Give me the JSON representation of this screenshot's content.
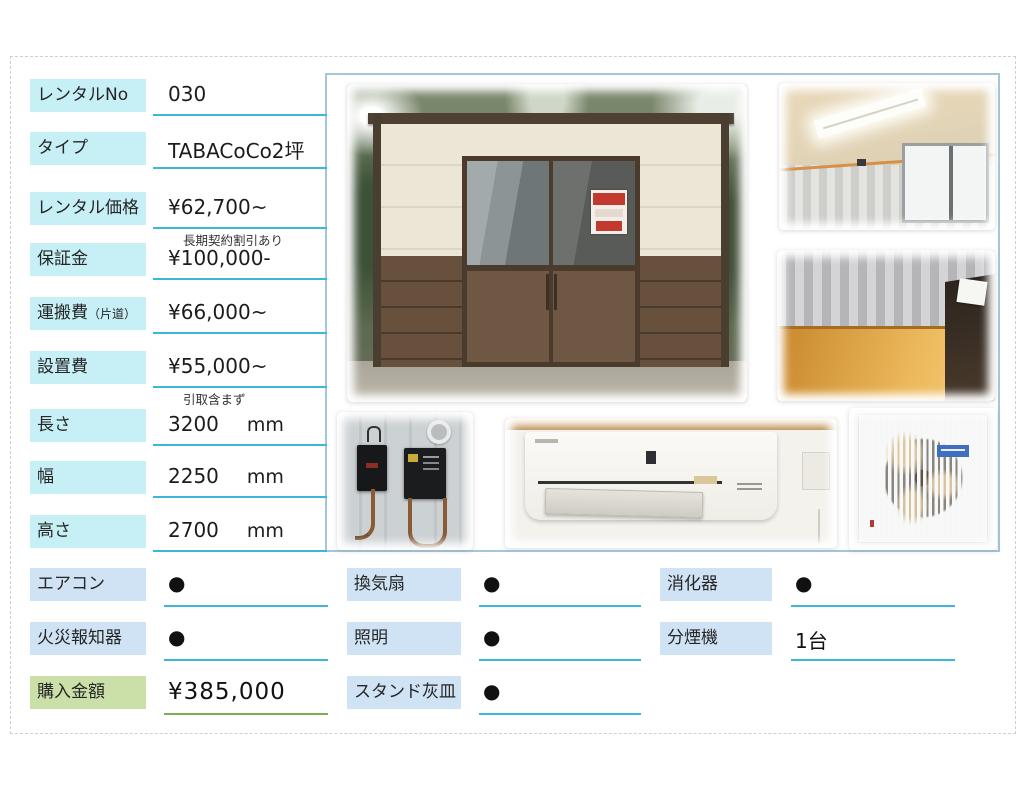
{
  "specs": [
    {
      "label": "レンタルNo",
      "suffix": "",
      "value": "030",
      "unit": "",
      "note": ""
    },
    {
      "label": "タイプ",
      "suffix": "",
      "value": "TABACoCo2坪",
      "unit": "",
      "note": ""
    },
    {
      "label": "レンタル価格",
      "suffix": "",
      "value": "¥62,700~",
      "unit": "",
      "note": "長期契約割引あり"
    },
    {
      "label": "保証金",
      "suffix": "",
      "value": "¥100,000-",
      "unit": "",
      "note": ""
    },
    {
      "label": "運搬費",
      "suffix": "（片道）",
      "value": "¥66,000~",
      "unit": "",
      "note": ""
    },
    {
      "label": "設置費",
      "suffix": "",
      "value": "¥55,000~",
      "unit": "",
      "note": "引取含まず"
    },
    {
      "label": "長さ",
      "suffix": "",
      "value": "3200",
      "unit": "mm",
      "note": ""
    },
    {
      "label": "幅",
      "suffix": "",
      "value": "2250",
      "unit": "mm",
      "note": ""
    },
    {
      "label": "高さ",
      "suffix": "",
      "value": "2700",
      "unit": "mm",
      "note": ""
    }
  ],
  "equipment": [
    {
      "label": "エアコン",
      "value": "●",
      "col": 0,
      "row": 0,
      "style": "blue"
    },
    {
      "label": "換気扇",
      "value": "●",
      "col": 1,
      "row": 0,
      "style": "blue"
    },
    {
      "label": "消化器",
      "value": "●",
      "col": 2,
      "row": 0,
      "style": "blue"
    },
    {
      "label": "火災報知器",
      "value": "●",
      "col": 0,
      "row": 1,
      "style": "blue"
    },
    {
      "label": "照明",
      "value": "●",
      "col": 1,
      "row": 1,
      "style": "blue"
    },
    {
      "label": "分煙機",
      "value": "1台",
      "col": 2,
      "row": 1,
      "style": "blue"
    },
    {
      "label": "購入金額",
      "value": "¥385,000",
      "col": 0,
      "row": 2,
      "style": "green"
    },
    {
      "label": "スタンド灰皿",
      "value": "●",
      "col": 1,
      "row": 2,
      "style": "blue"
    }
  ],
  "photos": {
    "items": [
      "exterior-front",
      "interior-ceiling-light",
      "interior-floor",
      "circuit-breakers",
      "air-conditioner",
      "ventilation-fan"
    ]
  },
  "colors": {
    "label_cyan": "#c6eff6",
    "label_blue": "#cfe3f5",
    "label_green": "#cbdfa8",
    "underline_cyan": "#3db6da",
    "underline_green": "#7fad52",
    "photo_border": "#a5c6d8",
    "sign_red": "#c23a2e"
  }
}
